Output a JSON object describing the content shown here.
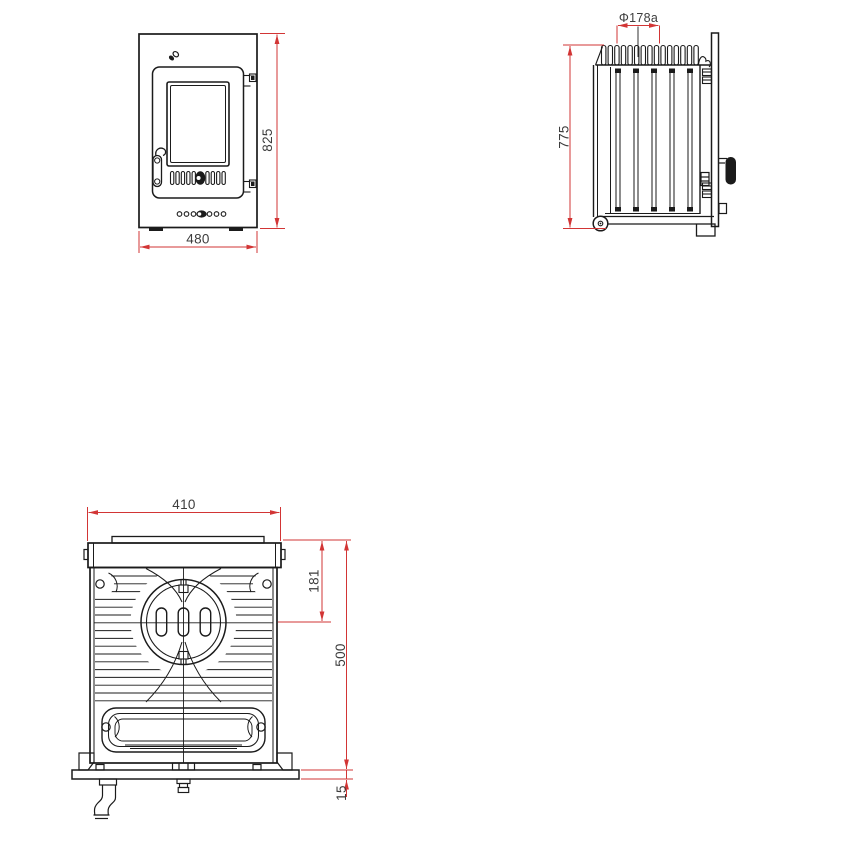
{
  "colors": {
    "background": "#ffffff",
    "drawing_ink": "#1b1b1b",
    "dimension_line": "#d23535",
    "dimension_text": "#3d3d3d"
  },
  "views": {
    "front": {
      "dims": {
        "height": "825",
        "width": "480"
      }
    },
    "side": {
      "dims": {
        "height": "775",
        "flue_diameter": "Φ178a"
      }
    },
    "rear": {
      "dims": {
        "width": "410",
        "flue_center_offset": "181",
        "height": "500",
        "base_thickness": "15"
      }
    }
  }
}
